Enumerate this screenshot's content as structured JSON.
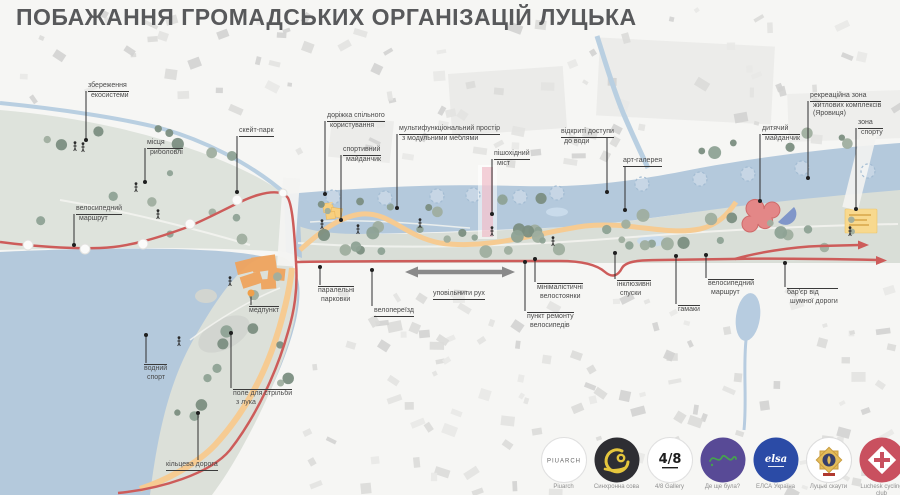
{
  "title": "ПОБАЖАННЯ ГРОМАДСЬКИХ ОРГАНІЗАЦІЙ ЛУЦЬКА",
  "map_labels": {
    "ecosystem": {
      "lines": [
        "збереження",
        "екосистеми"
      ]
    },
    "fishing": {
      "lines": [
        "місця",
        "риболовлі"
      ]
    },
    "bike_route_left": {
      "lines": [
        "велосипедний",
        "маршрут"
      ]
    },
    "skate_park": {
      "lines": [
        "скейт-парк"
      ]
    },
    "shared_path": {
      "lines": [
        "доріжка спільного",
        "користування"
      ]
    },
    "sports_ground": {
      "lines": [
        "спортивний",
        "майданчик"
      ]
    },
    "multifunctional_space": {
      "lines": [
        "мультифункціональний простір",
        "з модульними меблями"
      ]
    },
    "pedestrian_bridge": {
      "lines": [
        "пішохідний",
        "міст"
      ]
    },
    "water_access": {
      "lines": [
        "відкриті доступи",
        "до води"
      ]
    },
    "art_gallery": {
      "lines": [
        "арт-галерея"
      ]
    },
    "recreation_zone": {
      "lines": [
        "рекреаційна зона",
        "житлових комплексів",
        "(Яровиця)"
      ]
    },
    "kids_playground": {
      "lines": [
        "дитячий",
        "майданчик"
      ]
    },
    "sport_zone": {
      "lines": [
        "зона",
        "спорту"
      ]
    },
    "med_point": {
      "lines": [
        "медпункт"
      ]
    },
    "water_sport": {
      "lines": [
        "водний",
        "спорт"
      ]
    },
    "archery_field": {
      "lines": [
        "поле для стрільби",
        "з лука"
      ]
    },
    "ring_road": {
      "lines": [
        "кільцева дорога"
      ]
    },
    "parallel_parking": {
      "lines": [
        "паралельні",
        "парковки"
      ]
    },
    "bike_crossing": {
      "lines": [
        "велопереїзд"
      ]
    },
    "slow_traffic": {
      "lines": [
        "уповільнити рух"
      ]
    },
    "minimal_bike_racks": {
      "lines": [
        "мінімалістичні",
        "велостоянки"
      ]
    },
    "bike_repair": {
      "lines": [
        "пункт ремонту",
        "велосипедів"
      ]
    },
    "inclusive_ramps": {
      "lines": [
        "інклюзивні",
        "спуски"
      ]
    },
    "hammocks": {
      "lines": [
        "гамаки"
      ]
    },
    "bike_route_right": {
      "lines": [
        "велосипедний",
        "маршрут"
      ]
    },
    "noise_barrier": {
      "lines": [
        "бар'єр від",
        "шумної дороги"
      ]
    }
  },
  "logos": [
    {
      "name": "piuarch",
      "badge_text": "PIUARCH",
      "caption": "Piuarch"
    },
    {
      "name": "synchronna-sova",
      "badge_text": "",
      "caption": "Синхронна сова"
    },
    {
      "name": "4-8-gallery",
      "badge_text": "4/8",
      "caption": "4/8 Gallery"
    },
    {
      "name": "de-shche-bula",
      "badge_text": "",
      "caption": "Де ще була?"
    },
    {
      "name": "elsa-ukraine",
      "badge_text": "elsa",
      "caption": "ЕЛСА Україна"
    },
    {
      "name": "lutsk-scouts",
      "badge_text": "",
      "caption": "Луцькі скаути"
    },
    {
      "name": "luchesk-cycling-club",
      "badge_text": "",
      "caption": "Luchesk cycling club"
    }
  ],
  "colors": {
    "route_red": "#cd5c5a",
    "water": "#b4c9dc",
    "park": "#d9ded7",
    "path_orange": "#f6cb92",
    "building_highlight": "#efa45e",
    "title_gray": "#58595b"
  }
}
